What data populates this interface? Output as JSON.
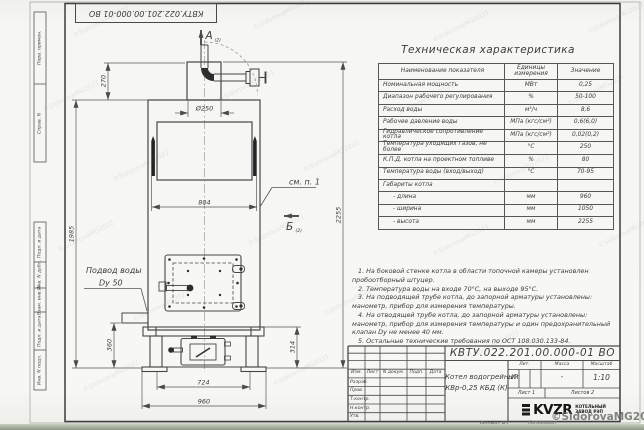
{
  "sheet": {
    "doc_number": "КВТУ.022.201.00.000-01 ВО",
    "product_name_1": "Котел водогрейный",
    "product_name_2": "КВр-0,25 КБД (К)",
    "liter": "И",
    "mass": "-",
    "scale": "1:10",
    "sheet_no": "Лист 1",
    "sheets_total": "Листов 2",
    "format": "Формат А3",
    "copied_by": "Копировал"
  },
  "stamp": {
    "col_izm": "Изм.",
    "col_list": "Лист",
    "col_doc": "N докум.",
    "col_sign": "Подп.",
    "col_date": "Дата",
    "row_razrab": "Разраб.",
    "row_prov": "Пров.",
    "row_tkontr": "Т.контр.",
    "row_nkontr": "Н.контр.",
    "row_utv": "Утв.",
    "lit": "Лит.",
    "mass": "Масса",
    "scale": "Масштаб"
  },
  "logo": {
    "brand": "KVZR",
    "line1": "КОТЕЛЬНЫЙ",
    "line2": "ЗАВОД РЭП"
  },
  "margins": {
    "s1": "Перв. примен.",
    "s2": "Справ. N",
    "s3": "Подп. и дата",
    "s4": "Инв. N дубл.",
    "s5": "Взам. инв. N",
    "s6": "Подп. и дата",
    "s7": "Инв. N подл."
  },
  "table": {
    "title": "Техническая характеристика",
    "headers": [
      "Наименование показателя",
      "Единицы измерения",
      "Значение"
    ],
    "rows": [
      [
        "Номинальная мощность",
        "МВт",
        "0,25"
      ],
      [
        "Диапазон рабочего регулирования",
        "%",
        "50-100"
      ],
      [
        "Расход воды",
        "м³/ч",
        "8,6"
      ],
      [
        "Рабочее давление воды",
        "МПа (кгс/см²)",
        "0,6(6,0)"
      ],
      [
        "Гидравлическое сопротивление котла",
        "МПа (кгс/см²)",
        "0,02(0,2)"
      ],
      [
        "Температура уходящих газов, не более",
        "°С",
        "250"
      ],
      [
        "К.П.Д. котла на проектном топливе",
        "%",
        "80"
      ],
      [
        "Температура воды (вход/выход)",
        "°С",
        "70-95"
      ],
      [
        "Габариты котла",
        "",
        ""
      ],
      [
        "- длина",
        "мм",
        "960"
      ],
      [
        "- ширина",
        "мм",
        "1050"
      ],
      [
        "- высота",
        "мм",
        "2255"
      ]
    ]
  },
  "notes": {
    "lines": [
      "1. На боковой стенке котла в области топочной камеры установлен",
      "пробоотборный штуцер.",
      "2. Температура воды на входе 70°С, на выходе 95°С.",
      "3. На подводящей трубе котла, до запорной арматуры установлены:",
      "манометр, прибор для измерения температуры.",
      "4. На отводящей трубе котла, до запорной арматуры установлены:",
      "манометр, прибор для измерения температуры и один предохранительный",
      "клапан Dy не менее 40 мм.",
      "5. Остальные технические требования по ОСТ 108.030.133-84."
    ]
  },
  "drawing": {
    "section_a": "А",
    "section_b": "Б",
    "view_ref": "(2)",
    "see_note": "см. п. 1",
    "water_label_1": "Подвод воды",
    "water_label_2": "Dy 50",
    "dims": {
      "h270": "270",
      "d250": "Ø250",
      "w804": "804",
      "h1985": "1985",
      "h2255": "2255",
      "h360": "360",
      "h314": "314",
      "w724": "724",
      "w960": "960"
    }
  },
  "watermark": {
    "tile": "©SidorovaMG2021",
    "copyright": "©SidorovaMG2021"
  }
}
